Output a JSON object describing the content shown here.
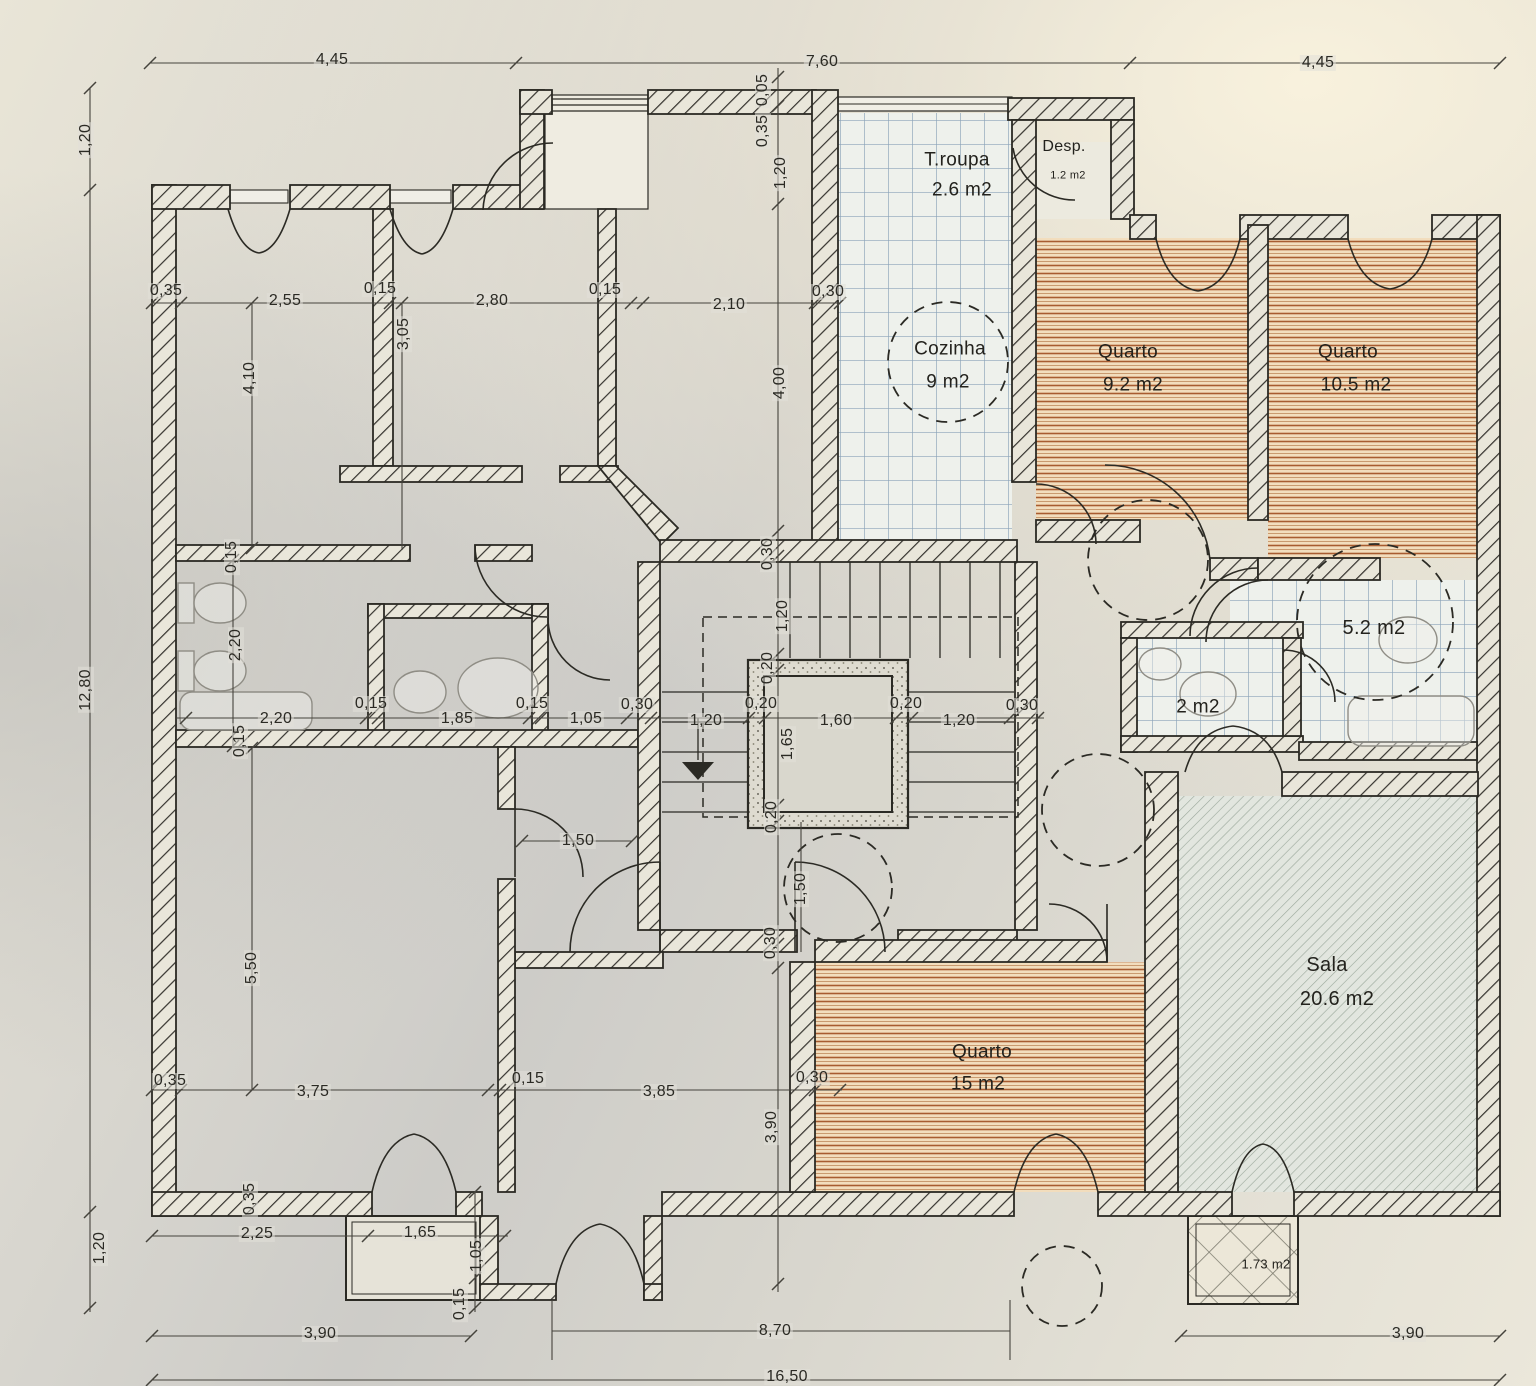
{
  "plan_title": "Floor plan",
  "rooms": {
    "troupa": {
      "name": "T.roupa",
      "area": "2.6 m2"
    },
    "desp": {
      "name": "Desp.",
      "area": "1.2 m2"
    },
    "cozinha": {
      "name": "Cozinha",
      "area": "9 m2"
    },
    "quarto_ne": {
      "name": "Quarto",
      "area": "9.2 m2"
    },
    "quarto_e": {
      "name": "Quarto",
      "area": "10.5 m2"
    },
    "banho": {
      "area": "5.2 m2"
    },
    "wc": {
      "area": "2 m2"
    },
    "sala": {
      "name": "Sala",
      "area": "20.6 m2"
    },
    "quarto_s": {
      "name": "Quarto",
      "area": "15 m2"
    },
    "varanda": {
      "area": "1.73 m2"
    }
  },
  "dims": {
    "top": [
      "4,45",
      "7,60",
      "4,45"
    ],
    "left": [
      "1,20",
      "12,80",
      "1,20"
    ],
    "entry_stack": [
      "0,05",
      "0,35",
      "1,20"
    ],
    "row_upper": [
      "0,35",
      "2,55",
      "0,15",
      "2,80",
      "0,15",
      "2,10",
      "0,30"
    ],
    "v_upper": [
      "3,05",
      "4,10",
      "4,00",
      "0,30"
    ],
    "v_bath": [
      "0,15",
      "2,20",
      "0,15"
    ],
    "row_mid": [
      "2,20",
      "0,15",
      "1,85",
      "0,15",
      "1,05",
      "0,30",
      "1,20",
      "0,20",
      "1,60",
      "0,20",
      "1,20",
      "0,30"
    ],
    "v_stair": [
      "1,20",
      "0,20",
      "1,65",
      "0,20"
    ],
    "hall": [
      "1,50",
      "1,50",
      "0,30"
    ],
    "v_left_low": [
      "5,50",
      "0,35"
    ],
    "row_lower": [
      "0,35",
      "3,75",
      "0,15",
      "3,85",
      "0,30"
    ],
    "v_quarto": [
      "3,90"
    ],
    "row_bottom_inner": [
      "2,25",
      "1,65"
    ],
    "v_bottom": [
      "1,05",
      "0,15"
    ],
    "row_bottom": [
      "3,90",
      "8,70",
      "3,90"
    ],
    "total": "16,50"
  }
}
